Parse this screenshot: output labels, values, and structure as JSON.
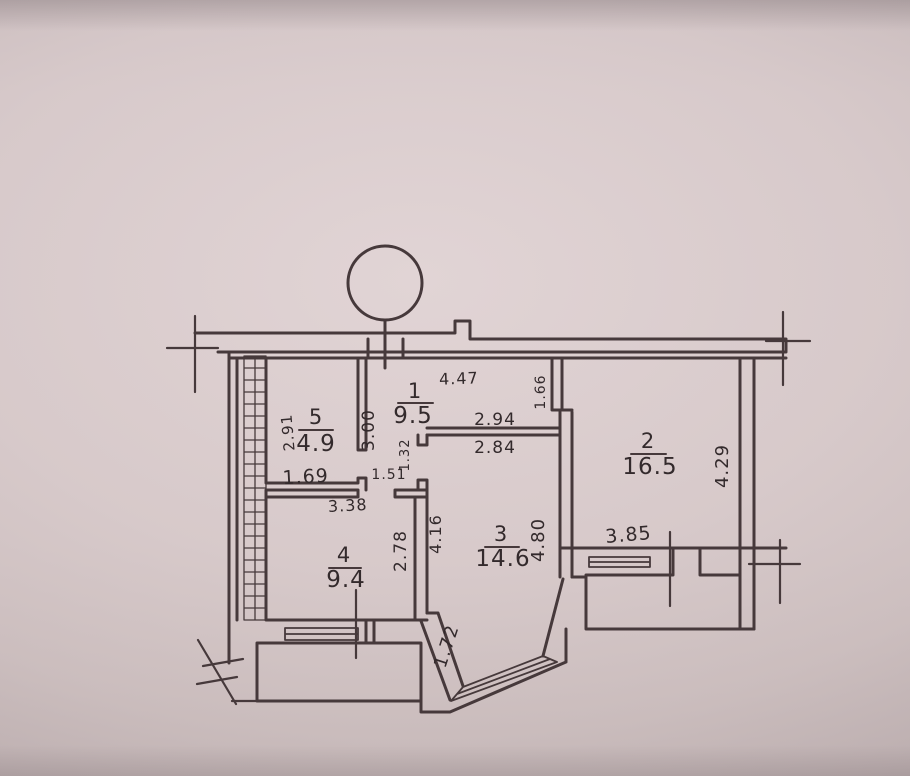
{
  "photo": {
    "description": "hand-drawn apartment floor plan sketch on paper"
  },
  "rooms": [
    {
      "number": "1",
      "area": "9.5"
    },
    {
      "number": "2",
      "area": "16.5"
    },
    {
      "number": "3",
      "area": "14.6"
    },
    {
      "number": "4",
      "area": "9.4"
    },
    {
      "number": "5",
      "area": "4.9"
    }
  ],
  "dims": {
    "hall_width": "4.47",
    "hall_height": "3.00",
    "hall_right": "1.66",
    "room5_height": "2.91",
    "room5_width": "1.69",
    "room3_top_outer": "2.94",
    "room3_top_inner": "2.84",
    "room2_right": "4.29",
    "room2_bottom": "3.85",
    "room3_left": "4.16",
    "room3_right": "4.80",
    "room4_width": "3.38",
    "room4_right": "2.78",
    "room3_diagonal": "1.72",
    "nook_width": "1.51",
    "nook_height": "1.32"
  }
}
